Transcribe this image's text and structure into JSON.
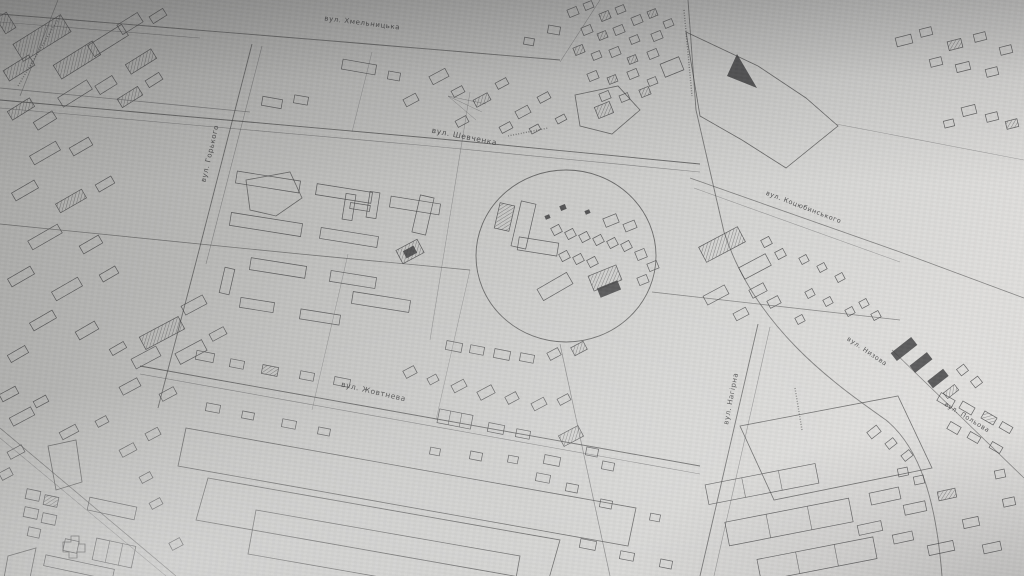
{
  "figure": {
    "kind": "photographed paper town plan, black ink on grey-white paper",
    "language": "Ukrainian (Cyrillic labels)"
  },
  "colors": {
    "paper_light": "#e1e0de",
    "paper_dark": "#a2a2a0",
    "ink": "#3a3a3b",
    "label_ink": "#2f2f30"
  },
  "map": {
    "street_labels": [
      {
        "id": "khmelnytska",
        "text": "вул. Хмельницька",
        "x": 362,
        "y": 25,
        "r": 7,
        "s": 7
      },
      {
        "id": "shevchenka",
        "text": "вул. Шевченка",
        "x": 464,
        "y": 139,
        "r": 11,
        "s": 7.5
      },
      {
        "id": "horkoho",
        "text": "вул. Горького",
        "x": 212,
        "y": 154,
        "r": -77,
        "s": 7
      },
      {
        "id": "kotsiubynskoho",
        "text": "вул. Коцюбинського",
        "x": 803,
        "y": 209,
        "r": 21,
        "s": 6.5
      },
      {
        "id": "zhovtneva",
        "text": "вул. Жовтнева",
        "x": 373,
        "y": 394,
        "r": 13,
        "s": 7.5
      },
      {
        "id": "nahirna",
        "text": "вул. Нагірна",
        "x": 733,
        "y": 399,
        "r": -79,
        "s": 7
      },
      {
        "id": "nyzova",
        "text": "вул. Низова",
        "x": 866,
        "y": 353,
        "r": 34,
        "s": 6.5
      },
      {
        "id": "polova",
        "text": "вул. Польова",
        "x": 966,
        "y": 419,
        "r": 32,
        "s": 6.5
      }
    ],
    "landmarks": {
      "stadium_circle": {
        "cx": 566,
        "cy": 256,
        "rx": 90,
        "ry": 86
      }
    }
  }
}
